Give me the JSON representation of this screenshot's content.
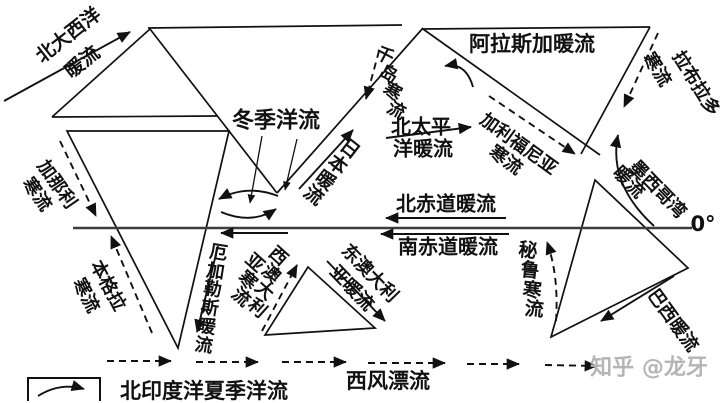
{
  "meta": {
    "bg_color": "#ffffff",
    "ink_color": "#111111",
    "equator_color": "#3d3d3d",
    "watermark_color": "#b5b5b5"
  },
  "equator": {
    "label": "0°"
  },
  "legend": {
    "text": "北印度洋夏季洋流",
    "symbol": "curved-arrow-icon"
  },
  "watermark": {
    "text": "知乎 @龙牙"
  },
  "currents_summary": [
    {
      "name": "北大西洋暖流",
      "type": "warm"
    },
    {
      "name": "加那利寒流",
      "type": "cold"
    },
    {
      "name": "本格拉寒流",
      "type": "cold"
    },
    {
      "name": "厄加勒斯暖流",
      "type": "warm"
    },
    {
      "name": "冬季洋流(北印度洋逆时针环流)",
      "type": "seasonal"
    },
    {
      "name": "日本暖流",
      "type": "warm"
    },
    {
      "name": "千岛寒流",
      "type": "cold"
    },
    {
      "name": "阿拉斯加暖流",
      "type": "warm"
    },
    {
      "name": "北太平洋暖流",
      "type": "warm"
    },
    {
      "name": "加利福尼亚寒流",
      "type": "cold"
    },
    {
      "name": "拉布拉多寒流",
      "type": "cold"
    },
    {
      "name": "墨西哥湾暖流",
      "type": "warm"
    },
    {
      "name": "北赤道暖流",
      "type": "warm"
    },
    {
      "name": "南赤道暖流",
      "type": "warm"
    },
    {
      "name": "秘鲁寒流",
      "type": "cold"
    },
    {
      "name": "巴西暖流",
      "type": "warm"
    },
    {
      "name": "西澳大利亚寒流",
      "type": "cold"
    },
    {
      "name": "东澳大利亚暖流",
      "type": "warm"
    },
    {
      "name": "西风漂流",
      "type": "drift"
    },
    {
      "name": "北印度洋夏季洋流",
      "type": "seasonal"
    }
  ],
  "labels": [
    {
      "name": "label-north-atlantic-warm-1",
      "text": "北大西洋",
      "x": 69,
      "y": 36,
      "rot": -38,
      "fs": 19,
      "mode": "h"
    },
    {
      "name": "label-north-atlantic-warm-2",
      "text": "暖流",
      "x": 83,
      "y": 63,
      "rot": -38,
      "fs": 19,
      "mode": "h"
    },
    {
      "name": "label-canary-cold-1",
      "text": "加那利",
      "x": 56,
      "y": 185,
      "rot": 55,
      "fs": 18,
      "mode": "h"
    },
    {
      "name": "label-canary-cold-2",
      "text": "寒流",
      "x": 36,
      "y": 195,
      "rot": 55,
      "fs": 18,
      "mode": "h"
    },
    {
      "name": "label-benguela-cold-1",
      "text": "本格拉",
      "x": 107,
      "y": 286,
      "rot": 62,
      "fs": 18,
      "mode": "h"
    },
    {
      "name": "label-benguela-cold-2",
      "text": "寒流",
      "x": 85,
      "y": 296,
      "rot": 62,
      "fs": 18,
      "mode": "h"
    },
    {
      "name": "label-winter-current",
      "text": "冬季洋流",
      "x": 276,
      "y": 122,
      "rot": 0,
      "fs": 22,
      "mode": "h"
    },
    {
      "name": "label-japan-warm",
      "text": "日本暖流",
      "x": 331,
      "y": 173,
      "rot": 38,
      "fs": 19,
      "mode": "v",
      "charRot": 0
    },
    {
      "name": "label-kuril-cold",
      "text": "千岛寒流",
      "x": 390,
      "y": 84,
      "rot": -12,
      "fs": 18,
      "mode": "v",
      "charRot": 40
    },
    {
      "name": "label-alaska-warm",
      "text": "阿拉斯加暖流",
      "x": 532,
      "y": 45,
      "rot": 0,
      "fs": 21,
      "mode": "h"
    },
    {
      "name": "label-north-pacific-warm-1",
      "text": "北太平",
      "x": 421,
      "y": 127,
      "rot": 0,
      "fs": 20,
      "mode": "h"
    },
    {
      "name": "label-north-pacific-warm-2",
      "text": "洋暖流",
      "x": 423,
      "y": 149,
      "rot": 0,
      "fs": 20,
      "mode": "h"
    },
    {
      "name": "label-california-cold-1",
      "text": "加利福尼亚",
      "x": 518,
      "y": 145,
      "rot": 36,
      "fs": 18,
      "mode": "h"
    },
    {
      "name": "label-california-cold-2",
      "text": "寒流",
      "x": 505,
      "y": 161,
      "rot": 36,
      "fs": 18,
      "mode": "h"
    },
    {
      "name": "label-labrador-cold-1",
      "text": "拉布拉多",
      "x": 695,
      "y": 84,
      "rot": 58,
      "fs": 18,
      "mode": "h"
    },
    {
      "name": "label-labrador-cold-2",
      "text": "寒流",
      "x": 656,
      "y": 70,
      "rot": 58,
      "fs": 18,
      "mode": "h"
    },
    {
      "name": "label-gulf-mexico-warm-1",
      "text": "墨西哥湾",
      "x": 657,
      "y": 190,
      "rot": 46,
      "fs": 18,
      "mode": "h"
    },
    {
      "name": "label-gulf-mexico-warm-2",
      "text": "暖流",
      "x": 628,
      "y": 183,
      "rot": 46,
      "fs": 18,
      "mode": "h"
    },
    {
      "name": "label-north-equatorial-warm",
      "text": "北赤道暖流",
      "x": 446,
      "y": 204,
      "rot": 0,
      "fs": 20,
      "mode": "h"
    },
    {
      "name": "label-south-equatorial-warm",
      "text": "南赤道暖流",
      "x": 448,
      "y": 247,
      "rot": 0,
      "fs": 20,
      "mode": "h"
    },
    {
      "name": "label-agulhas-warm",
      "text": "厄加勒斯暖流",
      "x": 211,
      "y": 300,
      "rot": 9,
      "fs": 18,
      "mode": "v",
      "charRot": 0
    },
    {
      "name": "label-west-australia-cold-1",
      "text": "西澳大利",
      "x": 267,
      "y": 283,
      "rot": 22,
      "fs": 18,
      "mode": "v",
      "charRot": 20
    },
    {
      "name": "label-west-australia-cold-2",
      "text": "亚寒流",
      "x": 247,
      "y": 281,
      "rot": 22,
      "fs": 18,
      "mode": "v",
      "charRot": 20
    },
    {
      "name": "label-east-australia-warm-1",
      "text": "东澳大利",
      "x": 369,
      "y": 274,
      "rot": 46,
      "fs": 18,
      "mode": "h"
    },
    {
      "name": "label-east-australia-warm-2",
      "text": "亚暖流",
      "x": 351,
      "y": 289,
      "rot": 46,
      "fs": 18,
      "mode": "h"
    },
    {
      "name": "label-peru-cold",
      "text": "秘鲁寒流",
      "x": 531,
      "y": 281,
      "rot": -6,
      "fs": 19,
      "mode": "v",
      "charRot": 12
    },
    {
      "name": "label-brazil-warm",
      "text": "巴西暖流",
      "x": 672,
      "y": 321,
      "rot": 54,
      "fs": 18,
      "mode": "h"
    },
    {
      "name": "label-west-wind-drift",
      "text": "西风漂流",
      "x": 388,
      "y": 382,
      "rot": 0,
      "fs": 21,
      "mode": "h"
    },
    {
      "name": "label-legend-summer-current",
      "text": "北印度洋夏季洋流",
      "x": 204,
      "y": 392,
      "rot": 0,
      "fs": 21,
      "mode": "h"
    },
    {
      "name": "label-equator-0deg",
      "text": "0°",
      "x": 703,
      "y": 225,
      "rot": 0,
      "fs": 21,
      "mode": "h"
    },
    {
      "name": "watermark-zhihu",
      "text": "知乎 @龙牙",
      "x": 649,
      "y": 369,
      "rot": 0,
      "fs": 22,
      "mode": "h",
      "color": "#b5b5b5"
    }
  ],
  "coastlines": [
    {
      "name": "coast-europe-west",
      "d": "M52,117 L150,29"
    },
    {
      "name": "coast-europe-south",
      "d": "M52,117 L217,116"
    },
    {
      "name": "coast-asia-north",
      "d": "M148,28 L402,25"
    },
    {
      "name": "coast-asia-south",
      "d": "M150,29 L277,193"
    },
    {
      "name": "coast-asia-east",
      "d": "M277,193 L423,28"
    },
    {
      "name": "coast-africa",
      "d": "M67,131 L229,131 L178,348 Z"
    },
    {
      "name": "coast-australia",
      "d": "M308,267 L265,335 L375,328 Z"
    },
    {
      "name": "coast-north-america-top",
      "d": "M423,29 L650,27"
    },
    {
      "name": "coast-north-america-west",
      "d": "M423,29 L600,155"
    },
    {
      "name": "coast-north-america-east",
      "d": "M650,27 L581,154"
    },
    {
      "name": "coast-south-america",
      "d": "M595,180 L688,268 L551,337 Z"
    }
  ],
  "equator_line": {
    "name": "equator-line",
    "d": "M73,228 L692,228"
  },
  "solid_arrows": [
    {
      "name": "arrow-north-atlantic-warm",
      "d": "M4,101 L130,32"
    },
    {
      "name": "arrow-japan-warm",
      "d": "M299,189 L353,130"
    },
    {
      "name": "arrow-north-pacific-warm",
      "d": "M386,138 L471,127"
    },
    {
      "name": "arrow-north-equatorial",
      "d": "M506,218 L386,218"
    },
    {
      "name": "arrow-south-equatorial",
      "d": "M509,234 L381,234"
    },
    {
      "name": "arrow-south-indian-equatorial",
      "d": "M288,233 L221,233"
    },
    {
      "name": "arrow-agulhas-warm",
      "d": "M218,246 L197,332"
    },
    {
      "name": "arrow-east-australia-warm",
      "d": "M327,261 L385,321"
    },
    {
      "name": "arrow-brazil-warm",
      "d": "M674,276 L601,321"
    },
    {
      "name": "arrow-gulf-stream",
      "d": "M654,226 Q608,184 618,135"
    },
    {
      "name": "arrow-alaska-warm",
      "d": "M473,87 Q466,62 445,66"
    },
    {
      "name": "arrow-winter-gyre-top",
      "d": "M278,196 Q247,184 219,199"
    },
    {
      "name": "arrow-winter-gyre-bottom",
      "d": "M221,212 Q252,225 276,209"
    },
    {
      "name": "arrow-winter-leader-1",
      "d": "M262,136 L250,203",
      "w": 1.3
    },
    {
      "name": "arrow-winter-leader-2",
      "d": "M297,139 L285,190",
      "w": 1.3
    },
    {
      "name": "legend-curved-arrow-icon",
      "d": "M38,396 Q60,382 84,389"
    }
  ],
  "dashed_arrows": [
    {
      "name": "arrow-canary-cold",
      "d": "M60,141 L96,216"
    },
    {
      "name": "arrow-benguela-cold",
      "d": "M152,333 L111,236"
    },
    {
      "name": "arrow-kuril-cold",
      "d": "M379,51 L366,99"
    },
    {
      "name": "arrow-california-cold",
      "d": "M489,96 L575,154"
    },
    {
      "name": "arrow-labrador-cold",
      "d": "M658,33 L624,107"
    },
    {
      "name": "arrow-peru-cold",
      "d": "M556,321 Q559,276 547,242"
    },
    {
      "name": "arrow-west-australia-cold",
      "d": "M262,331 L297,265"
    },
    {
      "name": "arrow-west-wind-drift-1",
      "d": "M107,361 L171,361"
    },
    {
      "name": "arrow-west-wind-drift-2",
      "d": "M196,362 L258,362"
    },
    {
      "name": "arrow-west-wind-drift-3",
      "d": "M282,362 L346,362"
    },
    {
      "name": "arrow-west-wind-drift-4",
      "d": "M368,363 L445,363"
    },
    {
      "name": "arrow-west-wind-drift-5",
      "d": "M467,364 L519,364"
    },
    {
      "name": "arrow-west-wind-drift-6",
      "d": "M545,365 L597,366"
    }
  ],
  "legend_box": {
    "name": "legend-box",
    "x": 28,
    "y": 378,
    "w": 72,
    "h": 28
  }
}
